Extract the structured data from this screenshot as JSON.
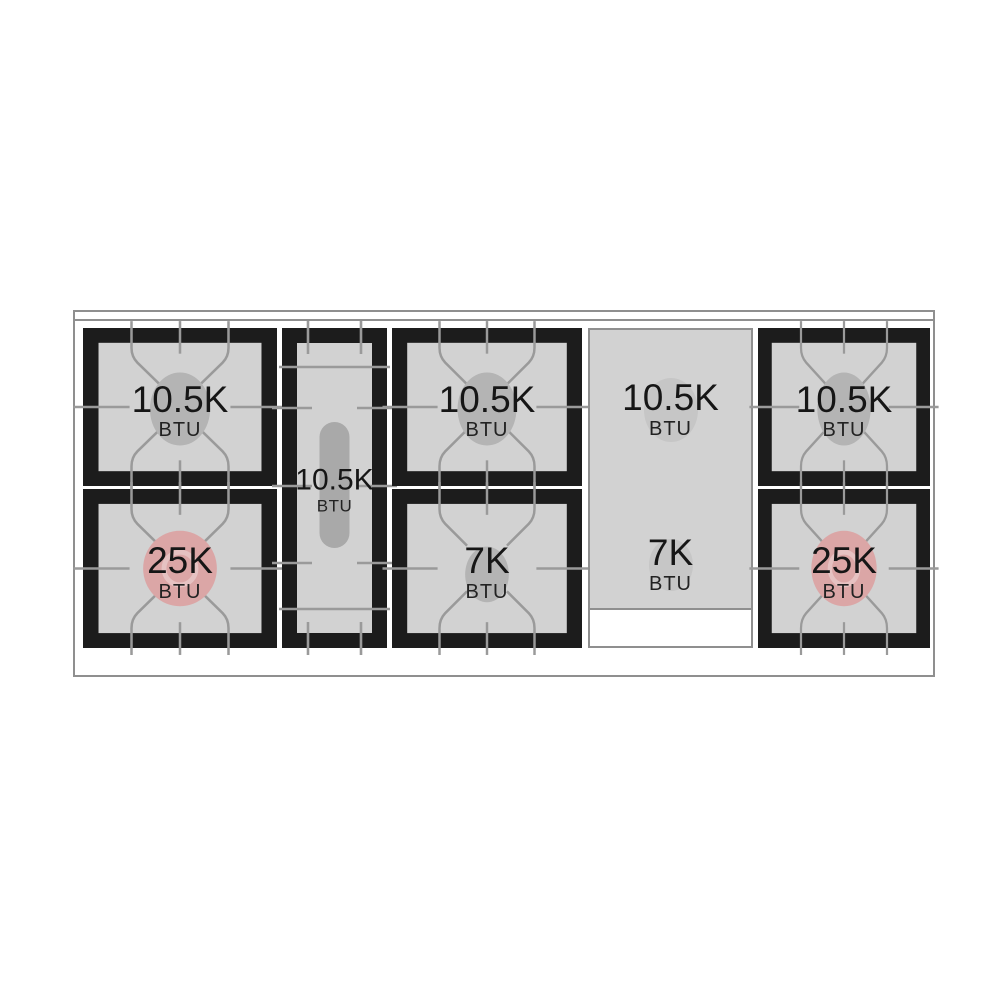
{
  "diagram": {
    "kind": "cooktop-burner-layout",
    "unit_label": "BTU"
  },
  "colors": {
    "background": "#ffffff",
    "frame_black": "#1c1c1c",
    "surface_gray": "#d2d2d2",
    "grate_line": "#9a9a9a",
    "burner_gray": "#b4b4b4",
    "burner_faint": "#c6c6c6",
    "oval_burner": "#a9a9a9",
    "power_pink": "#dba6a6",
    "pink_ring": "#e6c2c2",
    "edge_line": "#8f8f8f",
    "text": "#161616"
  },
  "sections": [
    {
      "id": "left-burner-pair",
      "type": "burner-pair",
      "burners": [
        {
          "value": "10.5K",
          "unit": "BTU",
          "style": "standard"
        },
        {
          "value": "25K",
          "unit": "BTU",
          "style": "power"
        }
      ]
    },
    {
      "id": "center-oval-burner",
      "type": "oval-burner",
      "burners": [
        {
          "value": "10.5K",
          "unit": "BTU",
          "style": "oval"
        }
      ]
    },
    {
      "id": "middle-burner-pair",
      "type": "burner-pair",
      "burners": [
        {
          "value": "10.5K",
          "unit": "BTU",
          "style": "standard"
        },
        {
          "value": "7K",
          "unit": "BTU",
          "style": "small"
        }
      ]
    },
    {
      "id": "griddle",
      "type": "griddle",
      "burners": [
        {
          "value": "10.5K",
          "unit": "BTU",
          "style": "faint"
        },
        {
          "value": "7K",
          "unit": "BTU",
          "style": "faint-small"
        }
      ]
    },
    {
      "id": "right-burner-pair",
      "type": "burner-pair",
      "burners": [
        {
          "value": "10.5K",
          "unit": "BTU",
          "style": "standard"
        },
        {
          "value": "25K",
          "unit": "BTU",
          "style": "power"
        }
      ]
    }
  ]
}
